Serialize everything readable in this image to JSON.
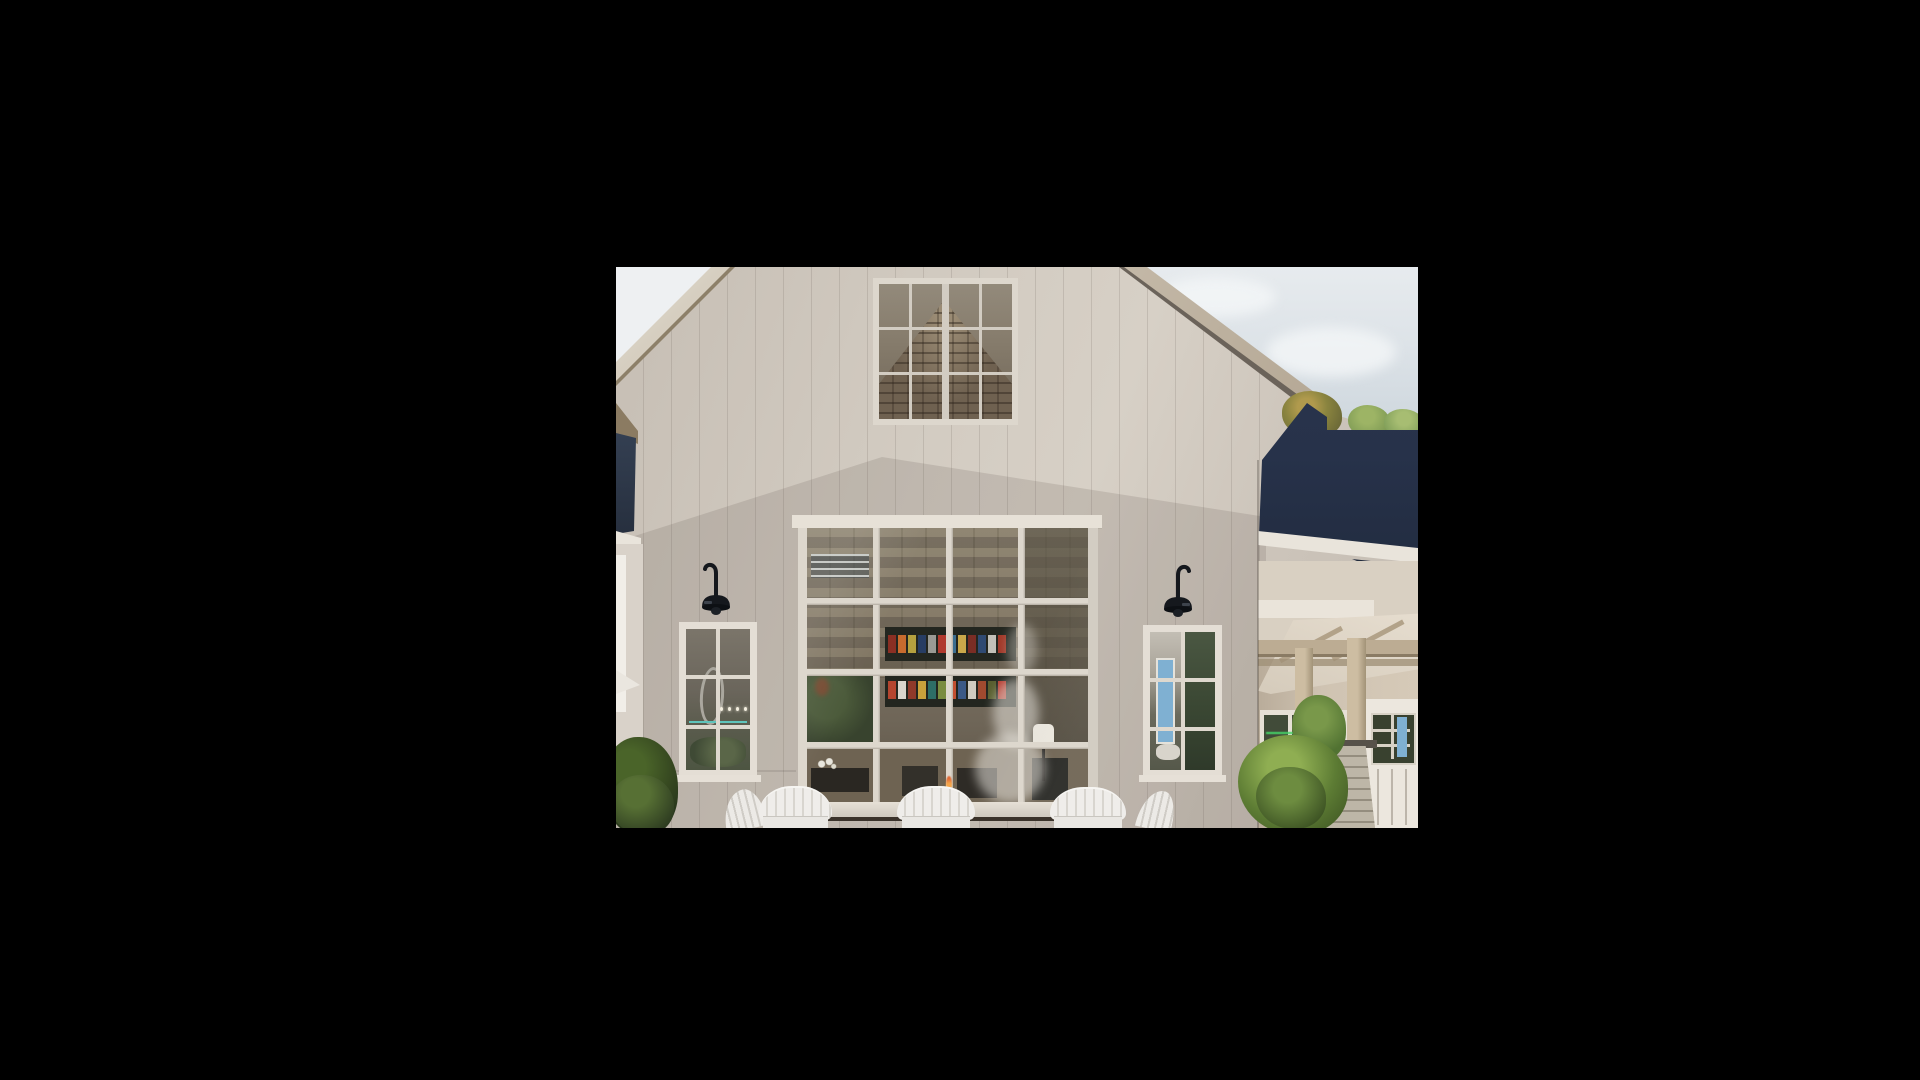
{
  "viewer": {
    "background": "#000000",
    "image_region": {
      "left": 616,
      "top": 267,
      "width": 802,
      "height": 561
    },
    "subject": "exterior rendering of a white modern farmhouse cafe with glazed window wall, sconces, adirondack chairs and topiary"
  },
  "palette": {
    "sky_left": "#eef0f2",
    "navy_left": "#45556c",
    "trim_white": "#e9e4db",
    "sconce_black": "#15181d",
    "teal_line": "#5fc4bb",
    "blue_door": "#7fb0d2",
    "pane_dark": "#3c452f",
    "glass_left_top": "#7b756a",
    "glass_left_mid": "#6a655b",
    "glass_left_bottom": "#4d5542",
    "glass_right_top": "#c3beb4",
    "glass_right_dark": "#3a4733",
    "attic_trim": "#ddd7cd",
    "flame_orange": "#e06a35",
    "chair_white": "#efedea",
    "stone_pier": "#b6afa0",
    "navy_roof": "#27324a"
  },
  "scene_objects": [
    "gable-wall",
    "attic-window",
    "left-roofline",
    "right-roofline",
    "sky",
    "left-sconce",
    "right-sconce",
    "left-window",
    "right-window",
    "window-wall",
    "interior-shelves",
    "steam-plume",
    "lamp",
    "flame",
    "adirondack-chairs",
    "left-bush",
    "right-topiary",
    "navy-roof-wing",
    "porch-beams",
    "porch-posts",
    "stone-pier",
    "carriage-door",
    "trees-behind-roof"
  ],
  "shelf_rows": [
    {
      "colors": [
        "#8a2f23",
        "#c76b2e",
        "#b5a13f",
        "#273d63",
        "#9a9a94",
        "#b03a2e",
        "#3c6e8f",
        "#caa84a",
        "#7a2d24",
        "#2f4a72",
        "#c2c0b8",
        "#a03828"
      ]
    },
    {
      "colors": [
        "#b4452f",
        "#d9d5cc",
        "#8f3a2a",
        "#c9a23c",
        "#2e6e66",
        "#7a8c3f",
        "#c25032",
        "#3b5a86",
        "#d0ccc0",
        "#a04a2f",
        "#585e2f",
        "#b43a2e"
      ]
    }
  ],
  "pendant_lights": {
    "count": 4,
    "color": "#f4efe0"
  }
}
